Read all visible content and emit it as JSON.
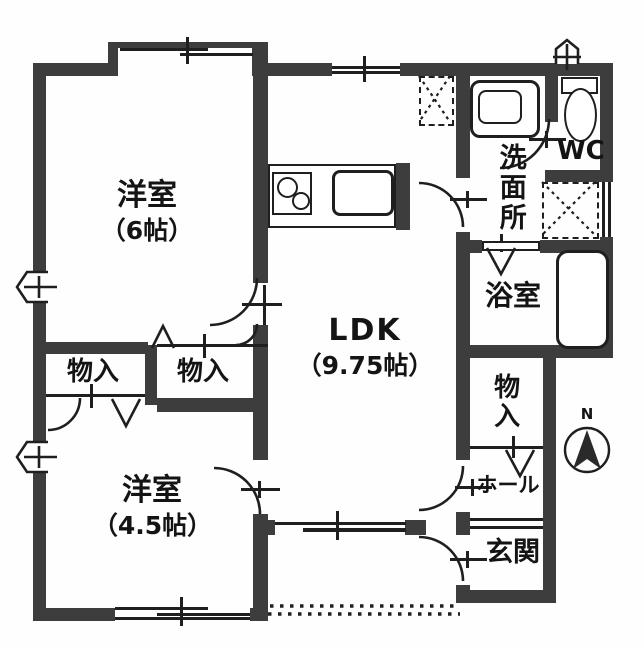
{
  "floorplan": {
    "rooms": {
      "bedroom_6": {
        "label": "洋室",
        "size": "（6帖）"
      },
      "ldk": {
        "label": "LDK",
        "size": "（9.75帖）"
      },
      "bedroom_4_5": {
        "label": "洋室",
        "size": "（4.5帖）"
      },
      "storage_a": {
        "label": "物入"
      },
      "storage_b": {
        "label": "物入"
      },
      "storage_c": {
        "label": "物入"
      },
      "washroom": {
        "label": "洗面所"
      },
      "wc": {
        "label": "WC"
      },
      "bathroom": {
        "label": "浴室"
      },
      "hall": {
        "label": "ホール"
      },
      "entrance": {
        "label": "玄関"
      }
    },
    "compass": {
      "north_label": "N"
    },
    "colors": {
      "wall": "#3d3d3d",
      "line": "#1f1f1f",
      "background": "#ffffff"
    }
  }
}
